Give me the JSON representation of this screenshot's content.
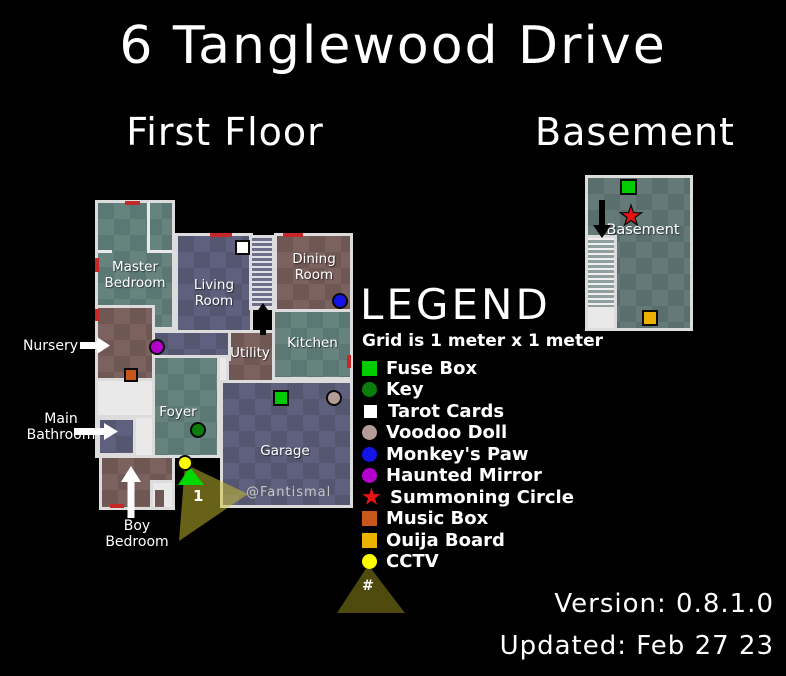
{
  "page": {
    "title": "6 Tanglewood Drive"
  },
  "headings": {
    "first_floor": "First Floor",
    "basement": "Basement"
  },
  "first_floor": {
    "rooms": {
      "master_bedroom": "Master Bedroom",
      "living_room": "Living Room",
      "dining_room": "Dining Room",
      "kitchen": "Kitchen",
      "utility": "Utility",
      "foyer": "Foyer",
      "garage": "Garage"
    },
    "callouts": {
      "nursery": "Nursery",
      "main_bathroom": "Main Bathroom",
      "boy_bedroom": "Boy Bedroom"
    },
    "camera_number": "1"
  },
  "basement": {
    "room_label": "Basement"
  },
  "legend": {
    "title": "LEGEND",
    "grid_note": "Grid is 1 meter x 1 meter",
    "items": [
      {
        "label": "Fuse Box",
        "shape": "square",
        "color": "#00cc00"
      },
      {
        "label": "Key",
        "shape": "circle",
        "color": "#0a7d0a"
      },
      {
        "label": "Tarot Cards",
        "shape": "square",
        "color": "#ffffff"
      },
      {
        "label": "Voodoo Doll",
        "shape": "circle",
        "color": "#b49c98"
      },
      {
        "label": "Monkey's Paw",
        "shape": "circle",
        "color": "#1414e6"
      },
      {
        "label": "Haunted Mirror",
        "shape": "circle",
        "color": "#b400cd"
      },
      {
        "label": "Summoning Circle",
        "shape": "star",
        "color": "#e81313"
      },
      {
        "label": "Music Box",
        "shape": "square",
        "color": "#c8571b"
      },
      {
        "label": "Ouija Board",
        "shape": "square",
        "color": "#edb100"
      },
      {
        "label": "CCTV",
        "shape": "circle",
        "color": "#ffff00"
      }
    ],
    "camera_symbol": "#"
  },
  "watermark": "@Fantismal",
  "footer": {
    "version": "Version: 0.8.1.0",
    "updated": "Updated: Feb 27 23"
  }
}
